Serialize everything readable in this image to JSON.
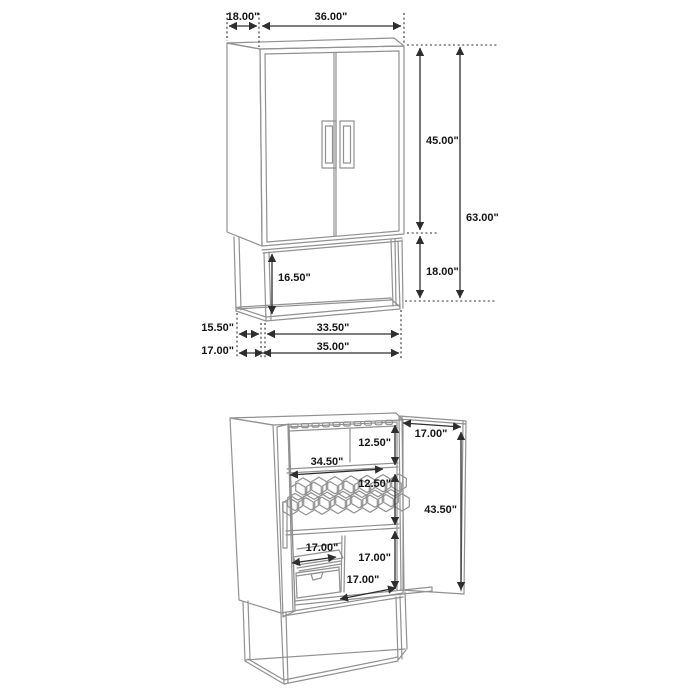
{
  "diagram": {
    "units": "inches",
    "colors": {
      "background": "#ffffff",
      "furniture_line": "#919191",
      "dimension_line": "#2e2e2e",
      "label_text": "#151515"
    },
    "closed": {
      "top_depth": "18.00\"",
      "top_width": "36.00\"",
      "cabinet_height": "45.00\"",
      "total_height": "63.00\"",
      "base_height": "18.00\"",
      "base_opening_height": "16.50\"",
      "base_depth_inner": "15.50\"",
      "base_depth": "17.00\"",
      "base_width_inner": "33.50\"",
      "base_width": "35.00\""
    },
    "open": {
      "stemware_section_height": "12.50\"",
      "shelf_width": "34.50\"",
      "wine_rack_height": "12.50\"",
      "door_width": "17.00\"",
      "door_height": "43.50\"",
      "tray_width": "17.00\"",
      "lower_section_height": "17.00\"",
      "base_platform_depth": "17.00\""
    }
  }
}
